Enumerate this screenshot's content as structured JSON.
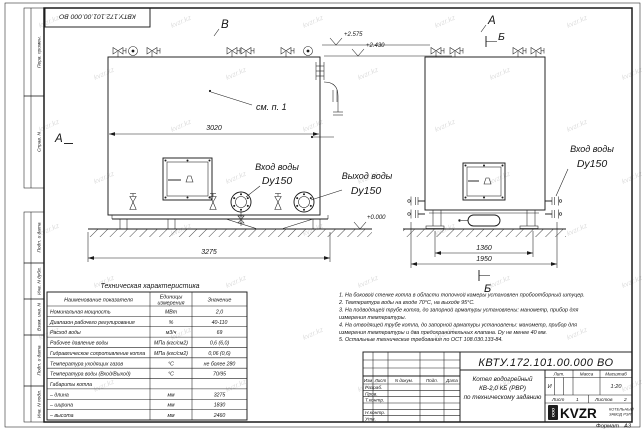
{
  "sheet": {
    "doc_number": "КВТУ.172.101.00.000 ВО",
    "format_label": "Формат",
    "format_value": "А3",
    "watermark": "kvzr.kz"
  },
  "markers": {
    "a_left": "А",
    "v_top": "В",
    "a_top": "А",
    "b_top": "Б",
    "b_bottom": "Б"
  },
  "front_view": {
    "see_note": "см. п. 1",
    "dim_width": "3020",
    "dim_base": "3275",
    "inlet_label": "Вход воды",
    "inlet_dn": "Dy150",
    "outlet_label": "Выход воды",
    "outlet_dn": "Dy150",
    "level_top": "+2.575",
    "level_mid": "+2.430",
    "level_zero": "+0.000"
  },
  "side_view": {
    "dim_inner": "1360",
    "dim_outer": "1950",
    "inlet_label": "Вход воды",
    "inlet_dn": "Dy150"
  },
  "frame_fields": [
    "Перв. примен.",
    "Справ. N",
    "Подп. и дата",
    "Инв. N дубл.",
    "Взам. инв. N",
    "Подп. и дата",
    "Инв. N подл."
  ],
  "table": {
    "title": "Техническая характеристика",
    "col_name": "Наименование показателя",
    "col_units_1": "Единицы",
    "col_units_2": "измерения",
    "col_value": "Значение",
    "rows": [
      [
        "Номинальная мощность",
        "МВт",
        "2,0"
      ],
      [
        "Диапазон рабочего регулирования",
        "%",
        "40-110"
      ],
      [
        "Расход воды",
        "м3/ч",
        "69"
      ],
      [
        "Рабочее давление воды",
        "МПа (кгс/см2)",
        "0,6 (6,0)"
      ],
      [
        "Гидравлическое сопротивление котла",
        "МПа (кгс/см2)",
        "0,06 (0,6)"
      ],
      [
        "Температура уходящих газов",
        "°С",
        "не более 280"
      ],
      [
        "Температура воды (Вход/Выход)",
        "°С",
        "70/95"
      ],
      [
        "Габариты котла",
        "",
        ""
      ],
      [
        "– длина",
        "мм",
        "3275"
      ],
      [
        "– ширина",
        "мм",
        "1830"
      ],
      [
        "– высота",
        "мм",
        "2460"
      ]
    ]
  },
  "notes": [
    [
      "1. На боковой стенке котла в области топочной камеры установлен пробоотборный штуцер."
    ],
    [
      "2. Температура воды на входе 70°С, на выходе 95°С."
    ],
    [
      "3. На подводящей трубе котла, до запорной арматуры установлены: манометр, прибор для",
      "измерения температуры."
    ],
    [
      "4. На отводящей трубе котла, до запорной арматуры установлены: манометр, прибор для",
      "измерения температуры и два предохранительных клапана. Dу не менее 40 мм."
    ],
    [
      "5. Остальные технические требования по ОСТ 108.030.133-84."
    ]
  ],
  "title_block": {
    "doc_number": "КВТУ.172.101.00.000 ВО",
    "columns": [
      "Изм",
      "Лист",
      "N докум.",
      "Подп.",
      "Дата"
    ],
    "sign_rows": [
      "Разраб.",
      "Пров.",
      "Т.контр.",
      "",
      "Н.контр.",
      "Утв."
    ],
    "product": [
      "Котел водогрейный",
      "КВ-2,0 КБ (РВР)",
      "по техническому заданию"
    ],
    "lit_label": "Лит.",
    "mass_label": "Масса",
    "scale_label": "Масштаб",
    "lit_value": "И",
    "scale_value": "1:20",
    "sheet_label": "Лист",
    "sheet_value": "1",
    "sheets_label": "Листов",
    "sheets_value": "2",
    "logo_ooo": "ООО",
    "logo_text": "KVZR",
    "logo_caption_1": "КОТЕЛЬНЫЙ",
    "logo_caption_2": "ЗАВОД РЭП"
  }
}
